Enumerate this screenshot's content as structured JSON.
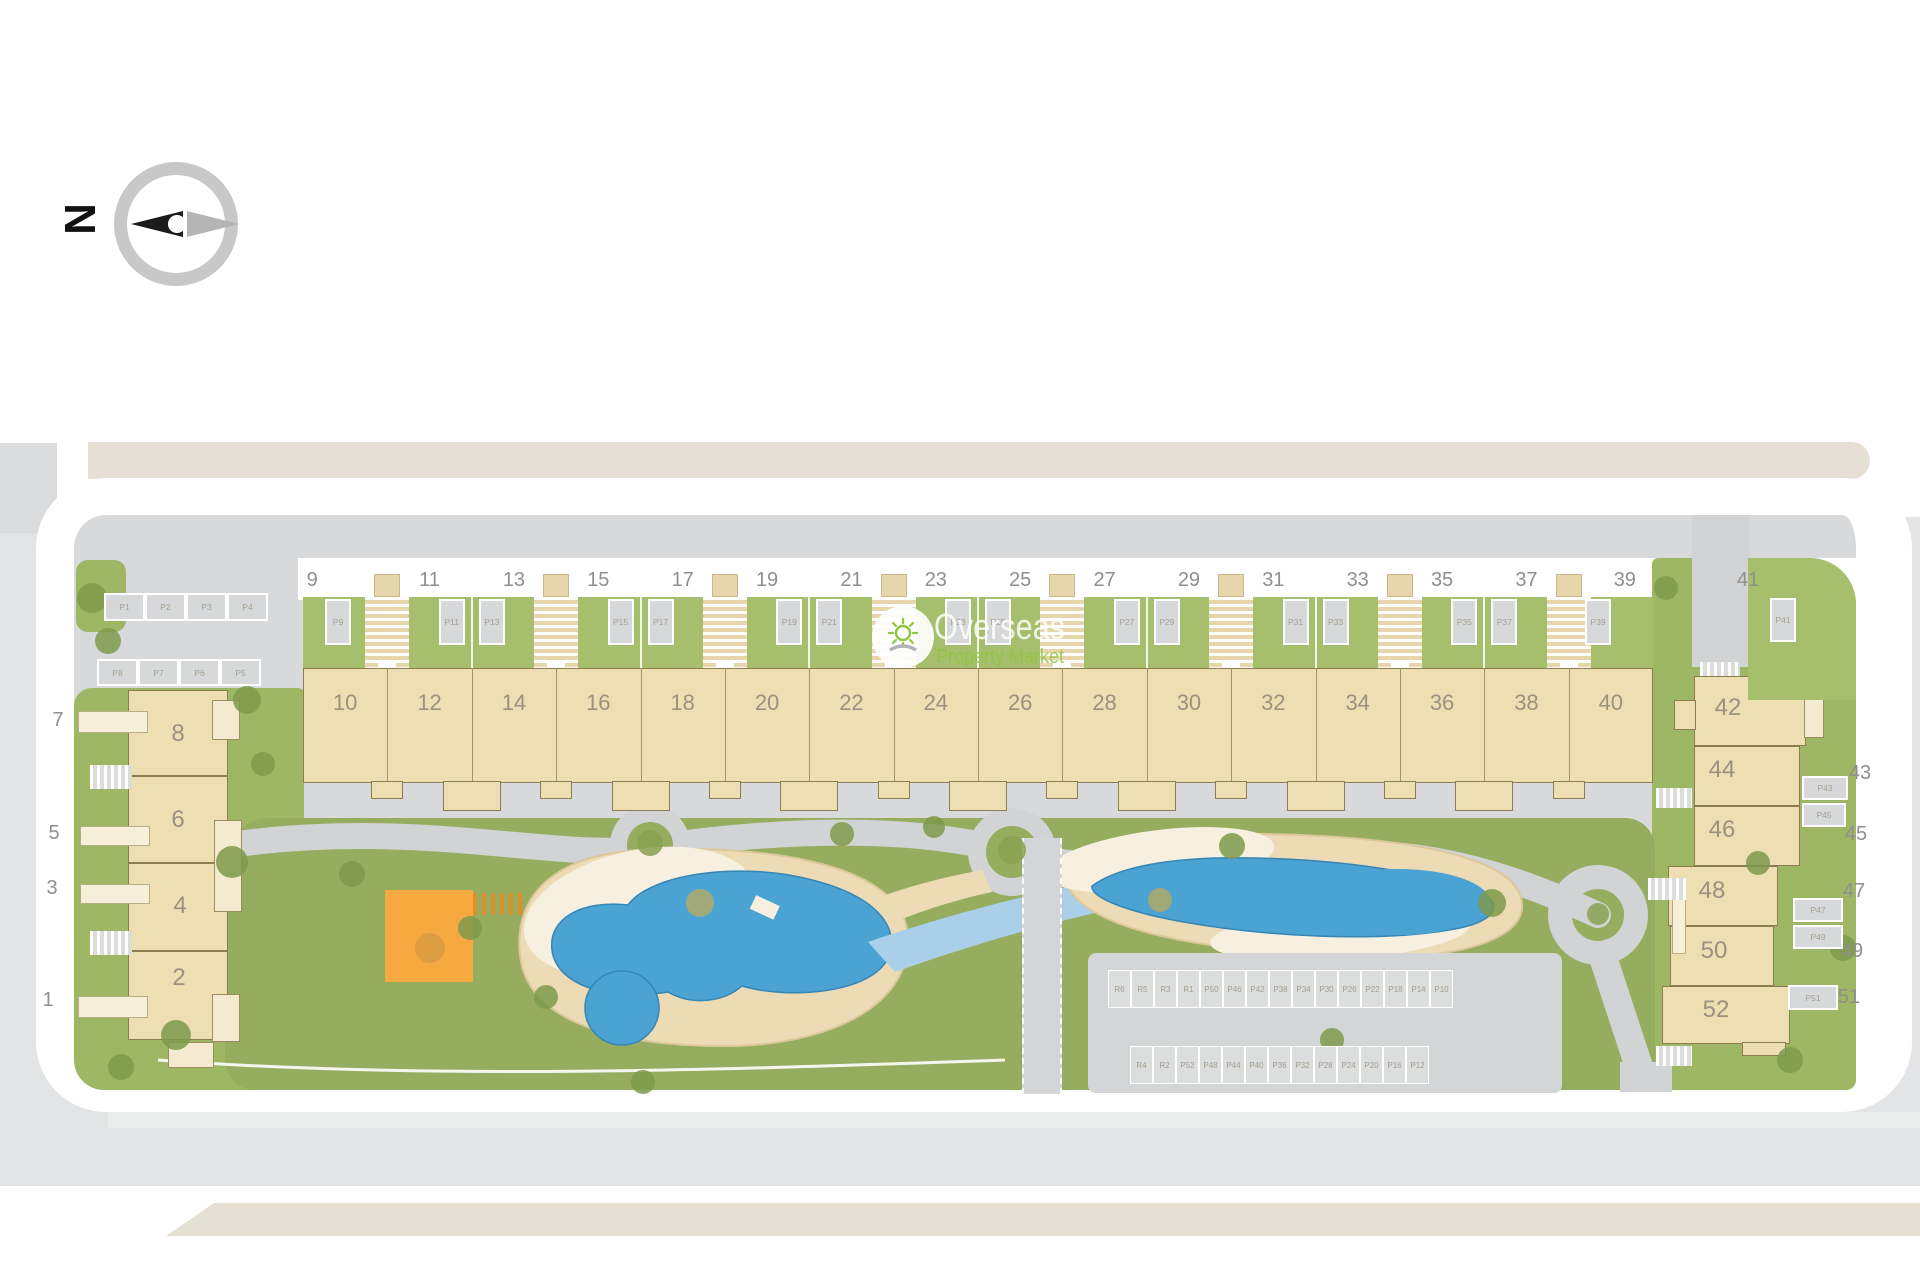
{
  "compass": {
    "north_letter": "N"
  },
  "watermark": {
    "brand": "Overseas",
    "tagline": "Property Market"
  },
  "carpark_nw": {
    "row1": [
      "P1",
      "P2",
      "P3",
      "P4"
    ],
    "row2": [
      "P8",
      "P7",
      "P6",
      "P5"
    ]
  },
  "top_row": {
    "street_numbers": [
      "9",
      "11",
      "13",
      "15",
      "17",
      "19",
      "21",
      "23",
      "25",
      "27",
      "29",
      "31",
      "33",
      "35",
      "37",
      "39",
      "41"
    ],
    "parking_labels": [
      "P9",
      "P11",
      "P13",
      "P15",
      "P17",
      "P19",
      "P21",
      "P23",
      "P25",
      "P27",
      "P29",
      "P31",
      "P33",
      "P35",
      "P37",
      "P39",
      "P41"
    ],
    "building_numbers": [
      "10",
      "12",
      "14",
      "16",
      "18",
      "20",
      "22",
      "24",
      "26",
      "28",
      "30",
      "32",
      "34",
      "36",
      "38",
      "40"
    ]
  },
  "left_block": {
    "building_numbers": [
      "8",
      "6",
      "4",
      "2"
    ],
    "street_numbers": [
      "7",
      "5",
      "3",
      "1"
    ]
  },
  "right_block": {
    "building_numbers": [
      "42",
      "44",
      "46",
      "48",
      "50",
      "52"
    ],
    "parking_labels": [
      "P43",
      "P45",
      "P47",
      "P49",
      "P51"
    ],
    "street_numbers": [
      "43",
      "45",
      "47",
      "49",
      "51"
    ]
  },
  "central_parking": {
    "row1": [
      "R6",
      "R5",
      "R3",
      "R1",
      "P50",
      "P46",
      "P42",
      "P38",
      "P34",
      "P30",
      "P26",
      "P22",
      "P18",
      "P14",
      "P10"
    ],
    "row2": [
      "R4",
      "R2",
      "P52",
      "P48",
      "P44",
      "P40",
      "P36",
      "P32",
      "P28",
      "P24",
      "P20",
      "P16",
      "P12"
    ]
  },
  "colors": {
    "lawn": "#96ad60",
    "garden": "#a6bf6c",
    "side_green": "#9db765",
    "pool": "#4ba3d3",
    "river": "#aacfe8",
    "sand": "#ecdbb5",
    "sand_light": "#f7f0e0",
    "building": "#eedfb2",
    "path": "#d2d3d4",
    "street": "#e3e4e5",
    "site": "#d8d9da",
    "road_white": "#ffffff",
    "sidewalk_beige": "#e5e0d3",
    "playground_orange": "#f5a93e",
    "watermark_green": "#8fc43f"
  }
}
